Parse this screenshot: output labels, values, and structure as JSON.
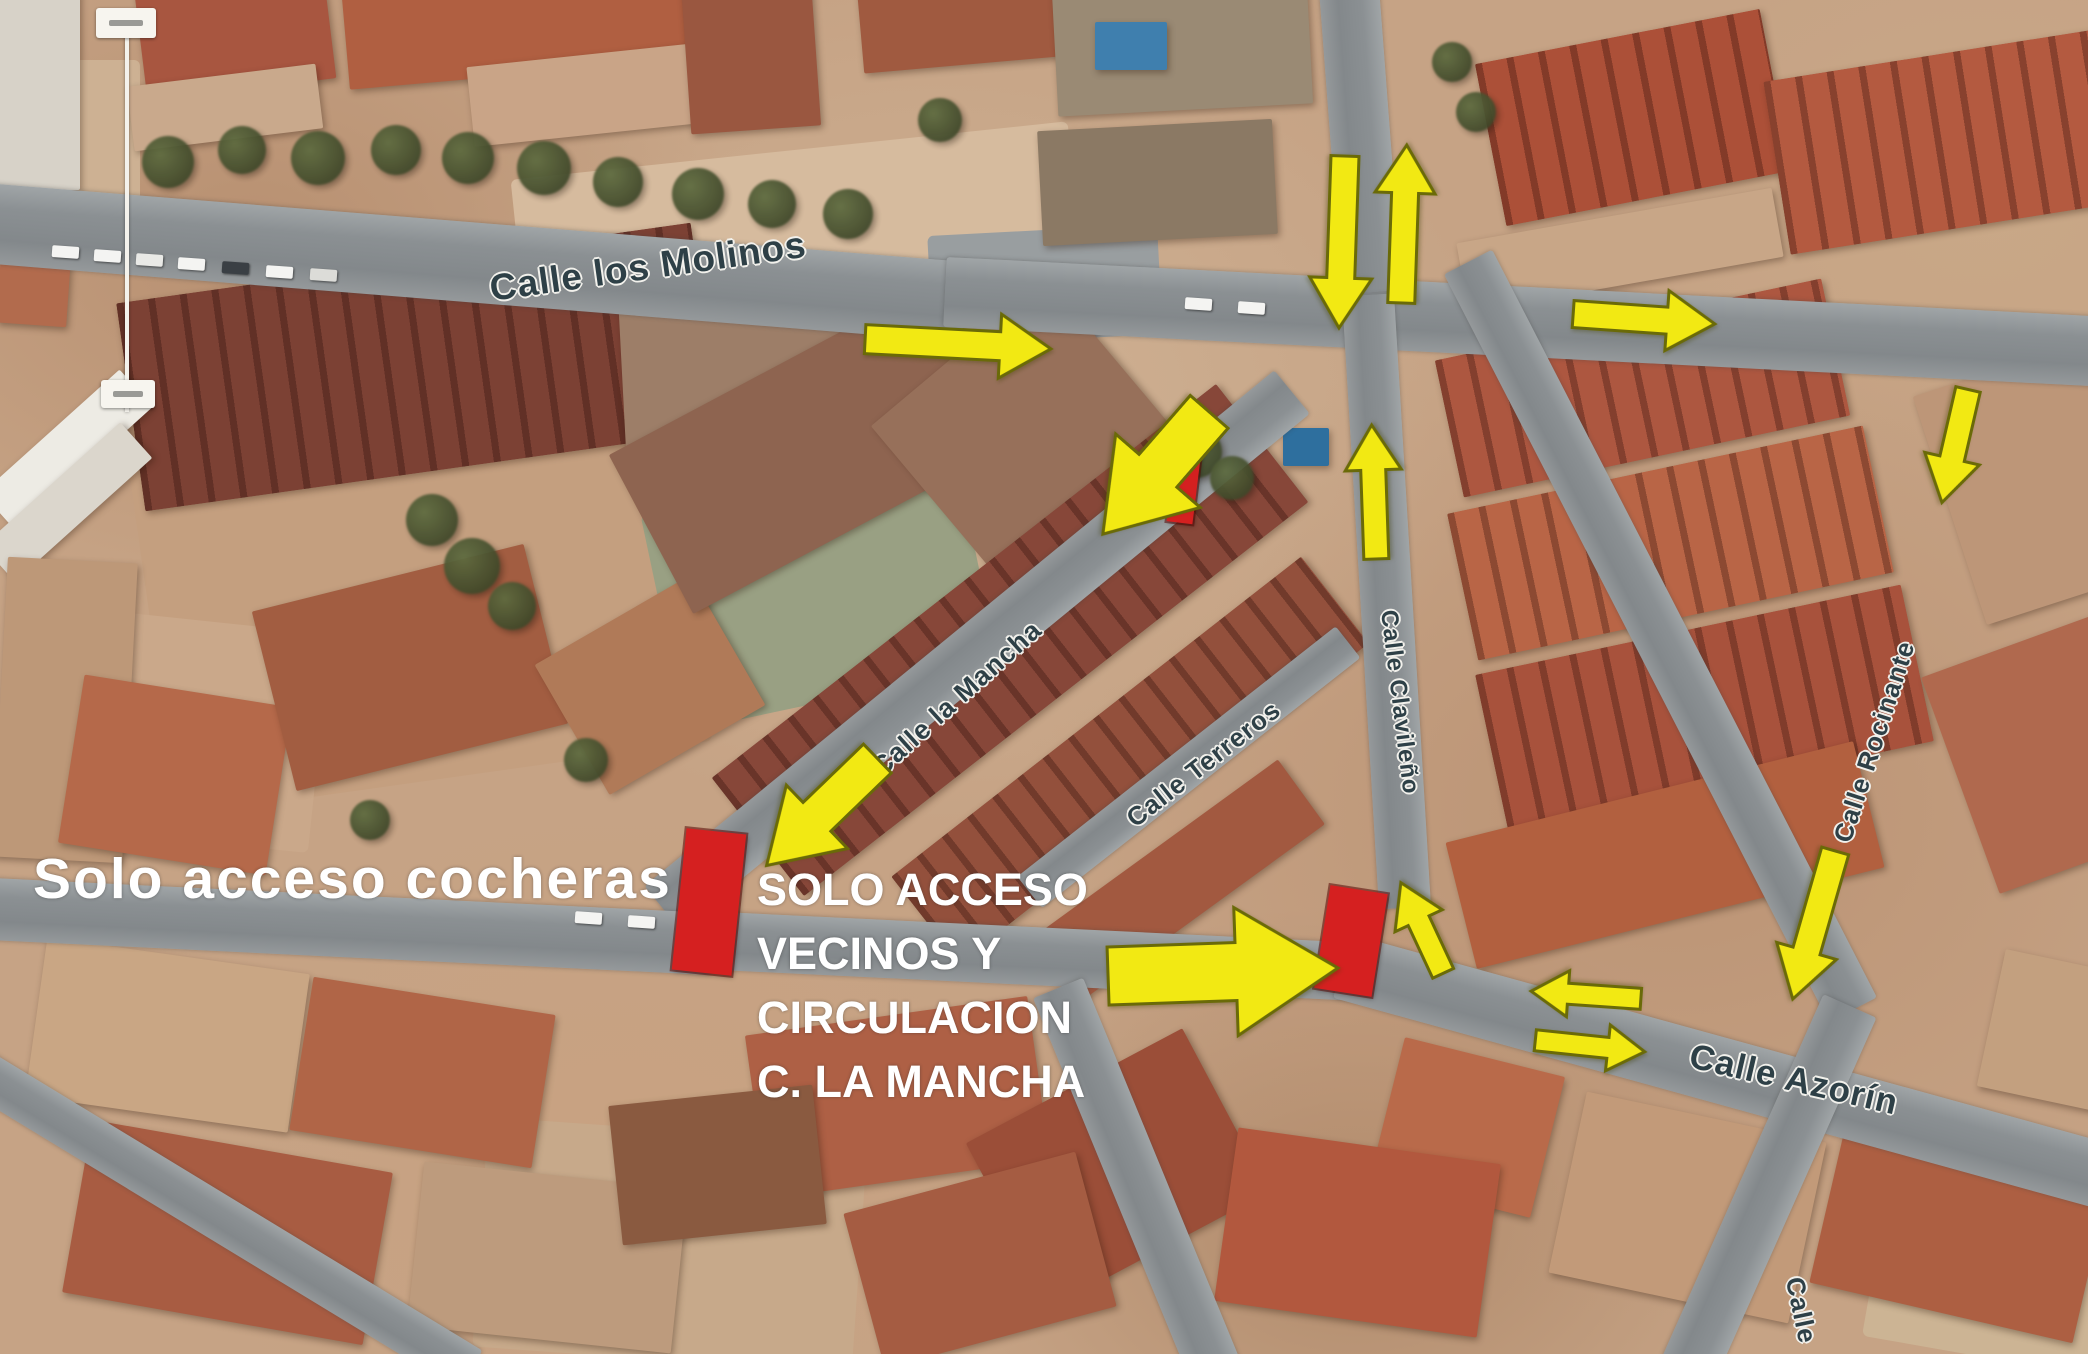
{
  "colors": {
    "arrow_fill": "#f2e913",
    "arrow_outline": "#6a6a08",
    "barrier_fill": "#d52020",
    "label_ink": "#2e4047",
    "label_halo": "#f2f1ec",
    "annotation_ink": "#ffffff",
    "road_gray": "#8b9093"
  },
  "map": {
    "annotations": {
      "left": {
        "text": "Solo acceso cocheras",
        "x": 33,
        "y": 846,
        "size": 57,
        "spacing": 2
      },
      "center": {
        "lines": [
          "SOLO ACCESO",
          "VECINOS Y",
          "CIRCULACION",
          "C. LA MANCHA"
        ],
        "x": 757,
        "y": 858,
        "size": 45,
        "line_height": 64
      }
    },
    "street_labels": [
      {
        "name": "street-label-calle-los-molinos",
        "text": "Calle los Molinos",
        "x": 490,
        "y": 268,
        "rot": -8,
        "size": 37
      },
      {
        "name": "street-label-calle-la-mancha",
        "text": "Calle la Mancha",
        "x": 876,
        "y": 756,
        "rot": -42,
        "size": 27
      },
      {
        "name": "street-label-calle-terreros",
        "text": "Calle Terreros",
        "x": 1130,
        "y": 806,
        "rot": -38,
        "size": 26
      },
      {
        "name": "street-label-calle-clavileno",
        "text": "Calle Clavileño",
        "x": 1388,
        "y": 596,
        "rot": 83,
        "size": 24
      },
      {
        "name": "street-label-calle-rocinante",
        "text": "Calle Rocinante",
        "x": 1842,
        "y": 826,
        "rot": -72,
        "size": 26
      },
      {
        "name": "street-label-calle-azorin",
        "text": "Calle Azorín",
        "x": 1690,
        "y": 1036,
        "rot": 13,
        "size": 35
      },
      {
        "name": "street-label-calle-south",
        "text": "Calle",
        "x": 1794,
        "y": 1262,
        "rot": 78,
        "size": 26
      }
    ],
    "arrows": [
      {
        "name": "arrow-molinos-west-right",
        "x": 958,
        "y": 344,
        "len": 186,
        "head": 64,
        "rot": 3
      },
      {
        "name": "arrow-junction-down",
        "x": 1342,
        "y": 242,
        "len": 172,
        "head": 62,
        "rot": 92
      },
      {
        "name": "arrow-junction-up",
        "x": 1404,
        "y": 224,
        "len": 158,
        "head": 60,
        "rot": -88
      },
      {
        "name": "arrow-molinos-east-right",
        "x": 1644,
        "y": 319,
        "len": 142,
        "head": 60,
        "rot": 4
      },
      {
        "name": "arrow-rocinante-down",
        "x": 1955,
        "y": 446,
        "len": 116,
        "head": 56,
        "rot": 103
      },
      {
        "name": "arrow-mancha-junction-downleft",
        "x": 1156,
        "y": 473,
        "len": 162,
        "head": 112,
        "rot": 131
      },
      {
        "name": "arrow-clavileno-up",
        "x": 1374,
        "y": 492,
        "len": 134,
        "head": 56,
        "rot": -92
      },
      {
        "name": "arrow-mancha-entry-downleft",
        "x": 822,
        "y": 812,
        "len": 154,
        "head": 88,
        "rot": 136
      },
      {
        "name": "arrow-central-main-right",
        "x": 1223,
        "y": 972,
        "len": 230,
        "head": 128,
        "rot": -2
      },
      {
        "name": "arrow-junction-turn-upleft",
        "x": 1422,
        "y": 928,
        "len": 100,
        "head": 52,
        "rot": -115
      },
      {
        "name": "arrow-azorin-west",
        "x": 1586,
        "y": 995,
        "len": 110,
        "head": 46,
        "rot": 184
      },
      {
        "name": "arrow-azorin-east",
        "x": 1590,
        "y": 1046,
        "len": 110,
        "head": 46,
        "rot": 6
      },
      {
        "name": "arrow-azorin-down",
        "x": 1814,
        "y": 925,
        "len": 154,
        "head": 62,
        "rot": 106
      }
    ],
    "barriers": [
      {
        "name": "barrier-mancha",
        "x": 1184,
        "y": 486,
        "w": 26,
        "h": 74,
        "rot": 7
      },
      {
        "name": "barrier-cocheras",
        "x": 709,
        "y": 902,
        "w": 60,
        "h": 142,
        "rot": 6
      },
      {
        "name": "barrier-central",
        "x": 1351,
        "y": 941,
        "w": 58,
        "h": 104,
        "rot": 9
      }
    ],
    "roads": [
      {
        "x1": -30,
        "y1": 222,
        "x2": 965,
        "y2": 302,
        "w": 80
      },
      {
        "x1": 945,
        "y1": 292,
        "x2": 2110,
        "y2": 352,
        "w": 70
      },
      {
        "x1": 1348,
        "y1": -25,
        "x2": 1372,
        "y2": 292,
        "w": 60
      },
      {
        "x1": 1368,
        "y1": 295,
        "x2": 1405,
        "y2": 908,
        "w": 52
      },
      {
        "x1": 1292,
        "y1": 392,
        "x2": 662,
        "y2": 908,
        "w": 56
      },
      {
        "x1": 1348,
        "y1": 642,
        "x2": 1030,
        "y2": 892,
        "w": 40
      },
      {
        "x1": -30,
        "y1": 908,
        "x2": 712,
        "y2": 944,
        "w": 62
      },
      {
        "x1": 700,
        "y1": 940,
        "x2": 1362,
        "y2": 972,
        "w": 58
      },
      {
        "x1": 1342,
        "y1": 966,
        "x2": 2110,
        "y2": 1178,
        "w": 66
      },
      {
        "x1": 1468,
        "y1": 262,
        "x2": 1853,
        "y2": 1010,
        "w": 54
      },
      {
        "x1": 1850,
        "y1": 1006,
        "x2": 1688,
        "y2": 1370,
        "w": 58
      },
      {
        "x1": 1058,
        "y1": 988,
        "x2": 1215,
        "y2": 1370,
        "w": 54
      },
      {
        "x1": -20,
        "y1": 1072,
        "x2": 470,
        "y2": 1370,
        "w": 46
      }
    ],
    "patches": [
      {
        "x": 520,
        "y": 150,
        "w": 560,
        "h": 210,
        "c": "#d6bb9e",
        "r": -6
      },
      {
        "x": 150,
        "y": 420,
        "w": 540,
        "h": 360,
        "c": "#c49f7f",
        "r": -8
      },
      {
        "x": 660,
        "y": 480,
        "w": 320,
        "h": 220,
        "c": "#99a083",
        "r": -12
      },
      {
        "x": 60,
        "y": 620,
        "w": 260,
        "h": 220,
        "c": "#caa88a",
        "r": 6
      },
      {
        "x": 1880,
        "y": 1130,
        "w": 260,
        "h": 230,
        "c": "#ccb494",
        "r": 10
      },
      {
        "x": 480,
        "y": 1130,
        "w": 380,
        "h": 230,
        "c": "#c7a98a",
        "r": 4
      },
      {
        "x": 930,
        "y": 230,
        "w": 230,
        "h": 110,
        "c": "#999ea0",
        "r": -3
      },
      {
        "x": 0,
        "y": 60,
        "w": 140,
        "h": 160,
        "c": "#cdb193",
        "r": 0
      }
    ],
    "buildings": [
      {
        "x": 128,
        "y": 262,
        "w": 580,
        "h": 210,
        "c": "#7c4134",
        "r": -8,
        "s": 1
      },
      {
        "x": 140,
        "y": -25,
        "w": 190,
        "h": 115,
        "c": "#a85640",
        "r": -7
      },
      {
        "x": 345,
        "y": -25,
        "w": 340,
        "h": 100,
        "c": "#b05f41",
        "r": -5
      },
      {
        "x": 470,
        "y": 55,
        "w": 230,
        "h": 80,
        "c": "#c9a487",
        "r": -6
      },
      {
        "x": 130,
        "y": 75,
        "w": 190,
        "h": 65,
        "c": "#c9a98c",
        "r": -7
      },
      {
        "x": 686,
        "y": -20,
        "w": 130,
        "h": 150,
        "c": "#9a5740",
        "r": -4
      },
      {
        "x": 0,
        "y": -10,
        "w": 80,
        "h": 200,
        "c": "#d7d2c8",
        "r": 0
      },
      {
        "x": 0,
        "y": 215,
        "w": 70,
        "h": 110,
        "c": "#b26b4d",
        "r": 4
      },
      {
        "x": -25,
        "y": 425,
        "w": 185,
        "h": 50,
        "c": "#edebe4",
        "r": -42
      },
      {
        "x": -25,
        "y": 478,
        "w": 185,
        "h": 48,
        "c": "#dbd6cc",
        "r": -42
      },
      {
        "x": 0,
        "y": 560,
        "w": 130,
        "h": 300,
        "c": "#bd9878",
        "r": 3
      },
      {
        "x": 70,
        "y": 690,
        "w": 210,
        "h": 170,
        "c": "#b5694a",
        "r": 9
      },
      {
        "x": 270,
        "y": 575,
        "w": 280,
        "h": 185,
        "c": "#a25d41",
        "r": -14
      },
      {
        "x": 560,
        "y": 610,
        "w": 180,
        "h": 150,
        "c": "#b07a58",
        "r": -30
      },
      {
        "x": 860,
        "y": -25,
        "w": 200,
        "h": 90,
        "c": "#a05a40",
        "r": -5
      },
      {
        "x": 1055,
        "y": -15,
        "w": 255,
        "h": 125,
        "c": "#9a8a74",
        "r": -3
      },
      {
        "x": 1040,
        "y": 125,
        "w": 235,
        "h": 115,
        "c": "#8b7964",
        "r": -3
      },
      {
        "x": 1095,
        "y": 22,
        "w": 72,
        "h": 48,
        "c": "#3f7fae",
        "r": 0
      },
      {
        "x": 622,
        "y": 292,
        "w": 470,
        "h": 150,
        "c": "#9d7e68",
        "r": -3
      },
      {
        "x": 630,
        "y": 360,
        "w": 360,
        "h": 180,
        "c": "#8e6450",
        "r": -28
      },
      {
        "x": 905,
        "y": 330,
        "w": 230,
        "h": 190,
        "c": "#97705a",
        "r": -40
      },
      {
        "x": 690,
        "y": 565,
        "w": 640,
        "h": 150,
        "c": "#874739",
        "r": -38,
        "s": 1
      },
      {
        "x": 870,
        "y": 705,
        "w": 520,
        "h": 110,
        "c": "#93503c",
        "r": -38,
        "s": 1
      },
      {
        "x": 1030,
        "y": 840,
        "w": 300,
        "h": 80,
        "c": "#a25940",
        "r": -36
      },
      {
        "x": 1445,
        "y": 318,
        "w": 395,
        "h": 140,
        "c": "#ad5740",
        "r": -12,
        "s": 1
      },
      {
        "x": 1458,
        "y": 468,
        "w": 425,
        "h": 150,
        "c": "#b96546",
        "r": -12,
        "s": 1
      },
      {
        "x": 1487,
        "y": 628,
        "w": 435,
        "h": 160,
        "c": "#a8523c",
        "r": -12,
        "s": 1
      },
      {
        "x": 1455,
        "y": 790,
        "w": 420,
        "h": 130,
        "c": "#b2603f",
        "r": -14
      },
      {
        "x": 1945,
        "y": 360,
        "w": 200,
        "h": 240,
        "c": "#bd9678",
        "r": -18
      },
      {
        "x": 1955,
        "y": 640,
        "w": 180,
        "h": 230,
        "c": "#b0694e",
        "r": -20
      },
      {
        "x": 1488,
        "y": 35,
        "w": 290,
        "h": 165,
        "c": "#ac5038",
        "r": -11,
        "s": 1
      },
      {
        "x": 1775,
        "y": 55,
        "w": 330,
        "h": 175,
        "c": "#b45a40",
        "r": -9,
        "s": 1
      },
      {
        "x": 1460,
        "y": 215,
        "w": 320,
        "h": 70,
        "c": "#c8a687",
        "r": -10
      },
      {
        "x": 1283,
        "y": 428,
        "w": 46,
        "h": 38,
        "c": "#2e6f9e",
        "r": 0
      },
      {
        "x": 1565,
        "y": 1115,
        "w": 245,
        "h": 185,
        "c": "#c29a79",
        "r": 12
      },
      {
        "x": 1825,
        "y": 1145,
        "w": 270,
        "h": 170,
        "c": "#ad5f42",
        "r": 13
      },
      {
        "x": 1385,
        "y": 1055,
        "w": 165,
        "h": 145,
        "c": "#b96a4a",
        "r": 14
      },
      {
        "x": 1990,
        "y": 960,
        "w": 120,
        "h": 140,
        "c": "#c3a07f",
        "r": 12
      },
      {
        "x": 755,
        "y": 1015,
        "w": 285,
        "h": 165,
        "c": "#ae6045",
        "r": -8
      },
      {
        "x": 995,
        "y": 1075,
        "w": 245,
        "h": 185,
        "c": "#9b4e38",
        "r": -28
      },
      {
        "x": 1225,
        "y": 1145,
        "w": 265,
        "h": 175,
        "c": "#b2583e",
        "r": 8
      },
      {
        "x": 860,
        "y": 1180,
        "w": 240,
        "h": 160,
        "c": "#a55c42",
        "r": -15
      },
      {
        "x": 35,
        "y": 955,
        "w": 265,
        "h": 160,
        "c": "#c9a684",
        "r": 8
      },
      {
        "x": 300,
        "y": 995,
        "w": 245,
        "h": 155,
        "c": "#b06547",
        "r": 9
      },
      {
        "x": 75,
        "y": 1145,
        "w": 305,
        "h": 175,
        "c": "#a85c42",
        "r": 10
      },
      {
        "x": 415,
        "y": 1175,
        "w": 265,
        "h": 165,
        "c": "#bd9b7d",
        "r": 6
      },
      {
        "x": 615,
        "y": 1095,
        "w": 205,
        "h": 140,
        "c": "#8a5a40",
        "r": -6
      }
    ],
    "trees": [
      {
        "x": 168,
        "y": 162,
        "r": 26
      },
      {
        "x": 242,
        "y": 150,
        "r": 24
      },
      {
        "x": 318,
        "y": 158,
        "r": 27
      },
      {
        "x": 396,
        "y": 150,
        "r": 25
      },
      {
        "x": 468,
        "y": 158,
        "r": 26
      },
      {
        "x": 544,
        "y": 168,
        "r": 27
      },
      {
        "x": 618,
        "y": 182,
        "r": 25
      },
      {
        "x": 698,
        "y": 194,
        "r": 26
      },
      {
        "x": 772,
        "y": 204,
        "r": 24
      },
      {
        "x": 848,
        "y": 214,
        "r": 25
      },
      {
        "x": 940,
        "y": 120,
        "r": 22
      },
      {
        "x": 432,
        "y": 520,
        "r": 26
      },
      {
        "x": 472,
        "y": 566,
        "r": 28
      },
      {
        "x": 512,
        "y": 606,
        "r": 24
      },
      {
        "x": 1196,
        "y": 452,
        "r": 26
      },
      {
        "x": 1232,
        "y": 478,
        "r": 22
      },
      {
        "x": 1452,
        "y": 62,
        "r": 20
      },
      {
        "x": 1476,
        "y": 112,
        "r": 20
      },
      {
        "x": 586,
        "y": 760,
        "r": 22
      },
      {
        "x": 370,
        "y": 820,
        "r": 20
      }
    ],
    "cars": [
      {
        "x": 52,
        "y": 246,
        "c": "#f4f4f2"
      },
      {
        "x": 94,
        "y": 250,
        "c": "#f4f4f2"
      },
      {
        "x": 136,
        "y": 254,
        "c": "#e9e9e6"
      },
      {
        "x": 178,
        "y": 258,
        "c": "#f4f4f2"
      },
      {
        "x": 222,
        "y": 262,
        "c": "#3a3f44"
      },
      {
        "x": 266,
        "y": 266,
        "c": "#f4f4f2"
      },
      {
        "x": 310,
        "y": 269,
        "c": "#dcdcd8"
      },
      {
        "x": 1185,
        "y": 298,
        "c": "#f4f4f2"
      },
      {
        "x": 1238,
        "y": 302,
        "c": "#f4f4f2"
      },
      {
        "x": 575,
        "y": 912,
        "c": "#f4f4f2"
      },
      {
        "x": 628,
        "y": 916,
        "c": "#f4f4f2"
      }
    ],
    "marker": {
      "line": {
        "x": 127,
        "y1": 16,
        "y2": 412,
        "w": 4
      },
      "box_top": {
        "x": 96,
        "y": 8,
        "w": 60,
        "h": 30
      },
      "box_bottom": {
        "x": 101,
        "y": 380,
        "w": 54,
        "h": 28
      }
    }
  }
}
